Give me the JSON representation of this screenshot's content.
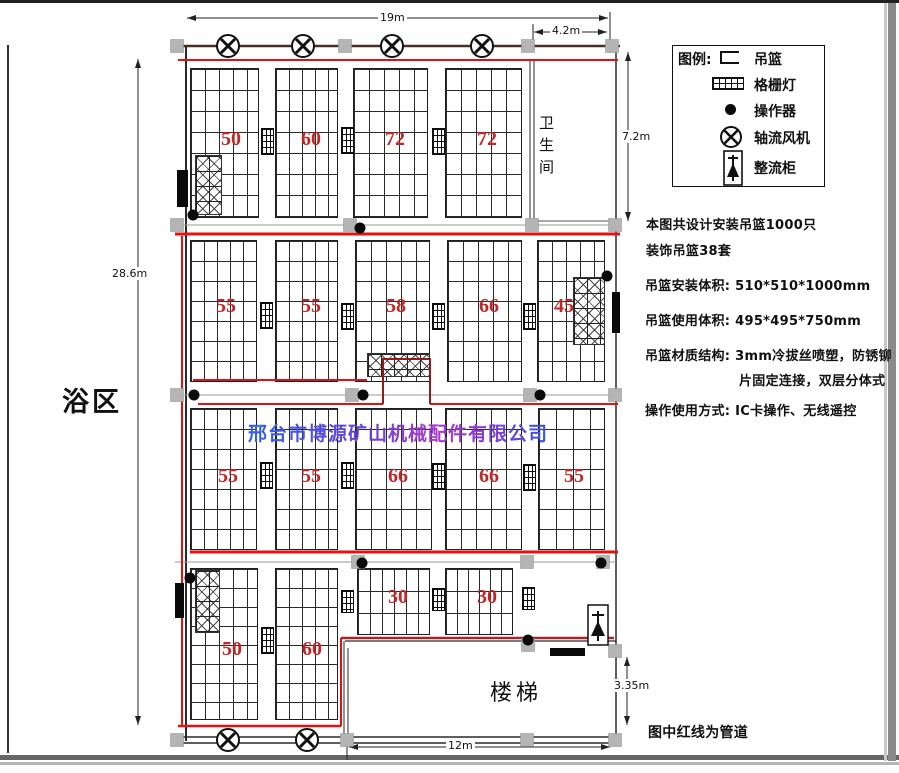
{
  "legend": {
    "title": "图例:",
    "items": [
      {
        "icon": "basket-symbol",
        "label": "吊篮"
      },
      {
        "icon": "grille-light-symbol",
        "label": "格栅灯"
      },
      {
        "icon": "operator-dot-symbol",
        "label": "操作器"
      },
      {
        "icon": "axial-fan-symbol",
        "label": "轴流风机"
      },
      {
        "icon": "rectifier-cabinet-symbol",
        "label": "整流柜"
      }
    ]
  },
  "notes": {
    "line1": "本图共设计安装吊篮1000只",
    "line2": "装饰吊篮38套",
    "line3": "吊篮安装体积: 510*510*1000mm",
    "line4": "吊篮使用体积: 495*495*750mm",
    "line5": "吊篮材质结构: 3mm冷拔丝喷塑，防锈铆",
    "line6": "片固定连接，双层分体式",
    "line7": "操作使用方式: IC卡操作、无线遥控"
  },
  "rooms": {
    "bath_area": "浴区",
    "toilet": "卫生间",
    "stairs": "楼梯"
  },
  "dimensions": {
    "top_width": "19m",
    "toilet_width": "4.2m",
    "toilet_height": "7.2m",
    "left_height": "28.6m",
    "stairs_width": "12m",
    "stairs_height": "3.35m"
  },
  "pipe_note": "图中红线为管道",
  "watermark": "邢台市博源矿山机械配件有限公司",
  "basket_counts": {
    "row1": [
      "50",
      "60",
      "72",
      "72"
    ],
    "row2": [
      "55",
      "55",
      "58",
      "66",
      "45"
    ],
    "row3": [
      "55",
      "55",
      "66",
      "66",
      "55"
    ],
    "row4": [
      "50",
      "60",
      "30",
      "30"
    ]
  },
  "colors": {
    "pipe_red": "#e31212",
    "count_red": "#c22525",
    "watermark_blue": "#2f62e8",
    "watermark_purple": "#a939cf",
    "column_gray": "#b4b4b4"
  }
}
